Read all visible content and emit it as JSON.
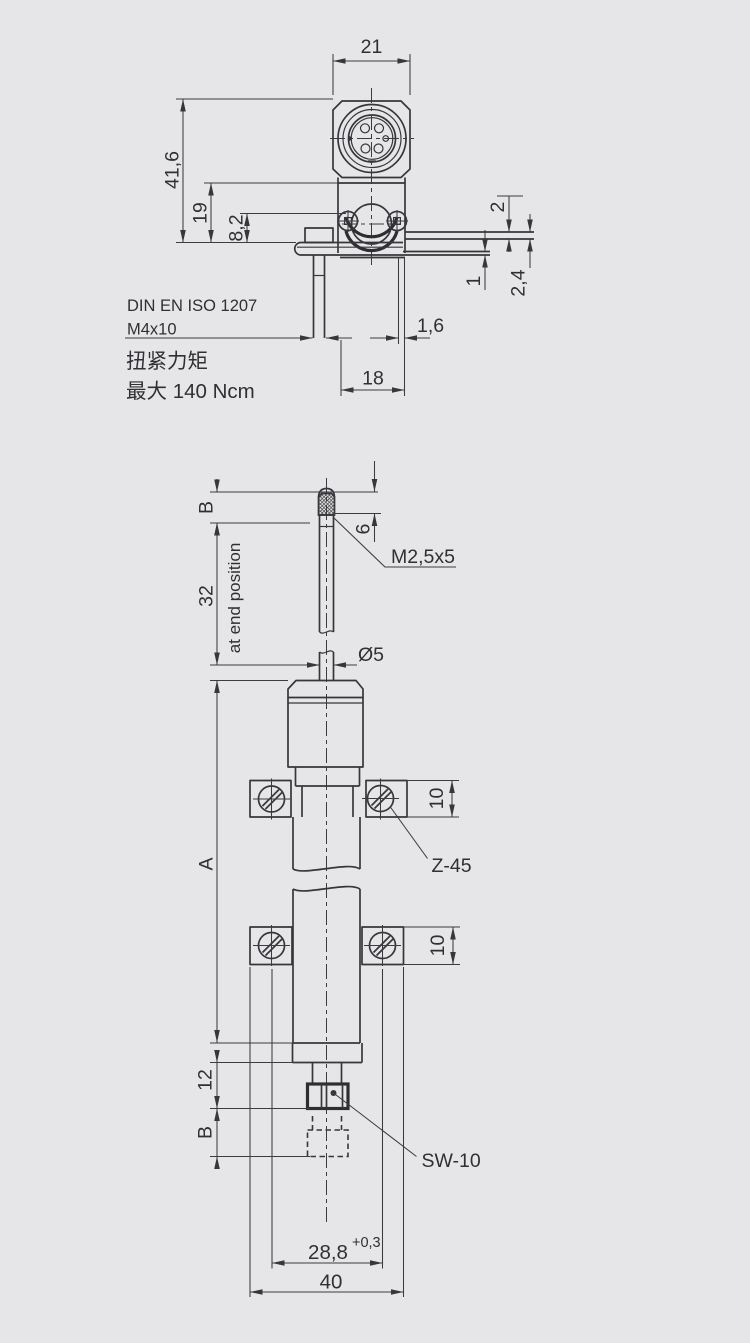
{
  "top_view": {
    "dim_width": "21",
    "dim_height_total": "41,6",
    "dim_height_body": "19",
    "dim_height_axis": "8,2",
    "dim_blade_2": "2",
    "dim_blade_2_4": "2,4",
    "dim_blade_1": "1",
    "dim_plate_1_6": "1,6",
    "dim_offset_18": "18",
    "note_standard": "DIN EN ISO 1207",
    "note_screw": "M4x10",
    "note_torque_title": "扭紧力矩",
    "note_torque_value": "最大 140 Ncm"
  },
  "side_view": {
    "dim_b_top": "B",
    "dim_stroke_32": "32",
    "dim_thread_len_6": "6",
    "label_thread": "M2,5x5",
    "label_end_position": "at end position",
    "dim_rod_dia": "Ø5",
    "dim_length_a": "A",
    "dim_clamp_upper_10": "10",
    "label_clamp_type": "Z-45",
    "dim_clamp_lower_10": "10",
    "dim_nut_12": "12",
    "dim_b_bottom": "B",
    "label_wrench_size": "SW-10",
    "dim_screw_spacing": "28,8",
    "dim_screw_spacing_tol": "+0,3",
    "dim_clamp_width_40": "40"
  }
}
